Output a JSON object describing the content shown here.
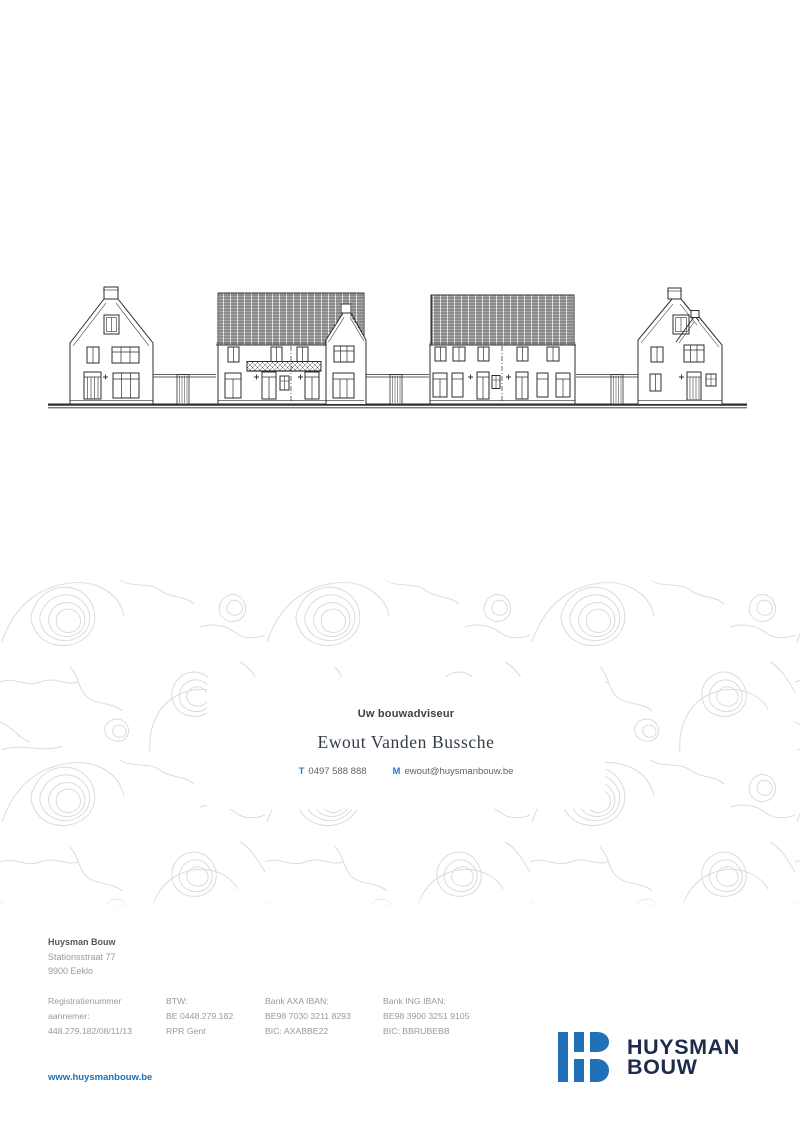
{
  "page": {
    "background": "#ffffff"
  },
  "elevation_drawing": {
    "alt": "Street elevation line drawing: four residential building groups with hatched tile roofs connected by garden walls",
    "line_color": "#2e2e2e"
  },
  "contact_card": {
    "heading": "Uw bouwadviseur",
    "name": "Ewout Vanden Bussche",
    "phone_label": "T",
    "phone": "0497 588 888",
    "email_label": "M",
    "email": "ewout@huysmanbouw.be"
  },
  "footer": {
    "company": "Huysman Bouw",
    "address_line1": "Stationsstraat 77",
    "address_line2": "9900 Eeklo",
    "columns": [
      {
        "lines": [
          "Registratienummer",
          "aannemer:",
          "448.279.182/08/11/13"
        ]
      },
      {
        "lines": [
          "BTW:",
          "BE 0448.279.182",
          "RPR Gent"
        ]
      },
      {
        "lines": [
          "Bank AXA IBAN:",
          "BE98 7030 3211 8293",
          "BIC: AXABBE22"
        ]
      },
      {
        "lines": [
          "Bank ING IBAN:",
          "BE98 3900 3251 9105",
          "BIC: BBRUBEBB"
        ]
      }
    ],
    "website": "www.huysmanbouw.be"
  },
  "logo": {
    "line1": "HUYSMAN",
    "line2": "BOUW"
  },
  "colors": {
    "accent_blue": "#2171b8",
    "navy": "#1d2b4c",
    "text_gray": "#959aa2",
    "contour_gray": "#d8dbe0"
  }
}
